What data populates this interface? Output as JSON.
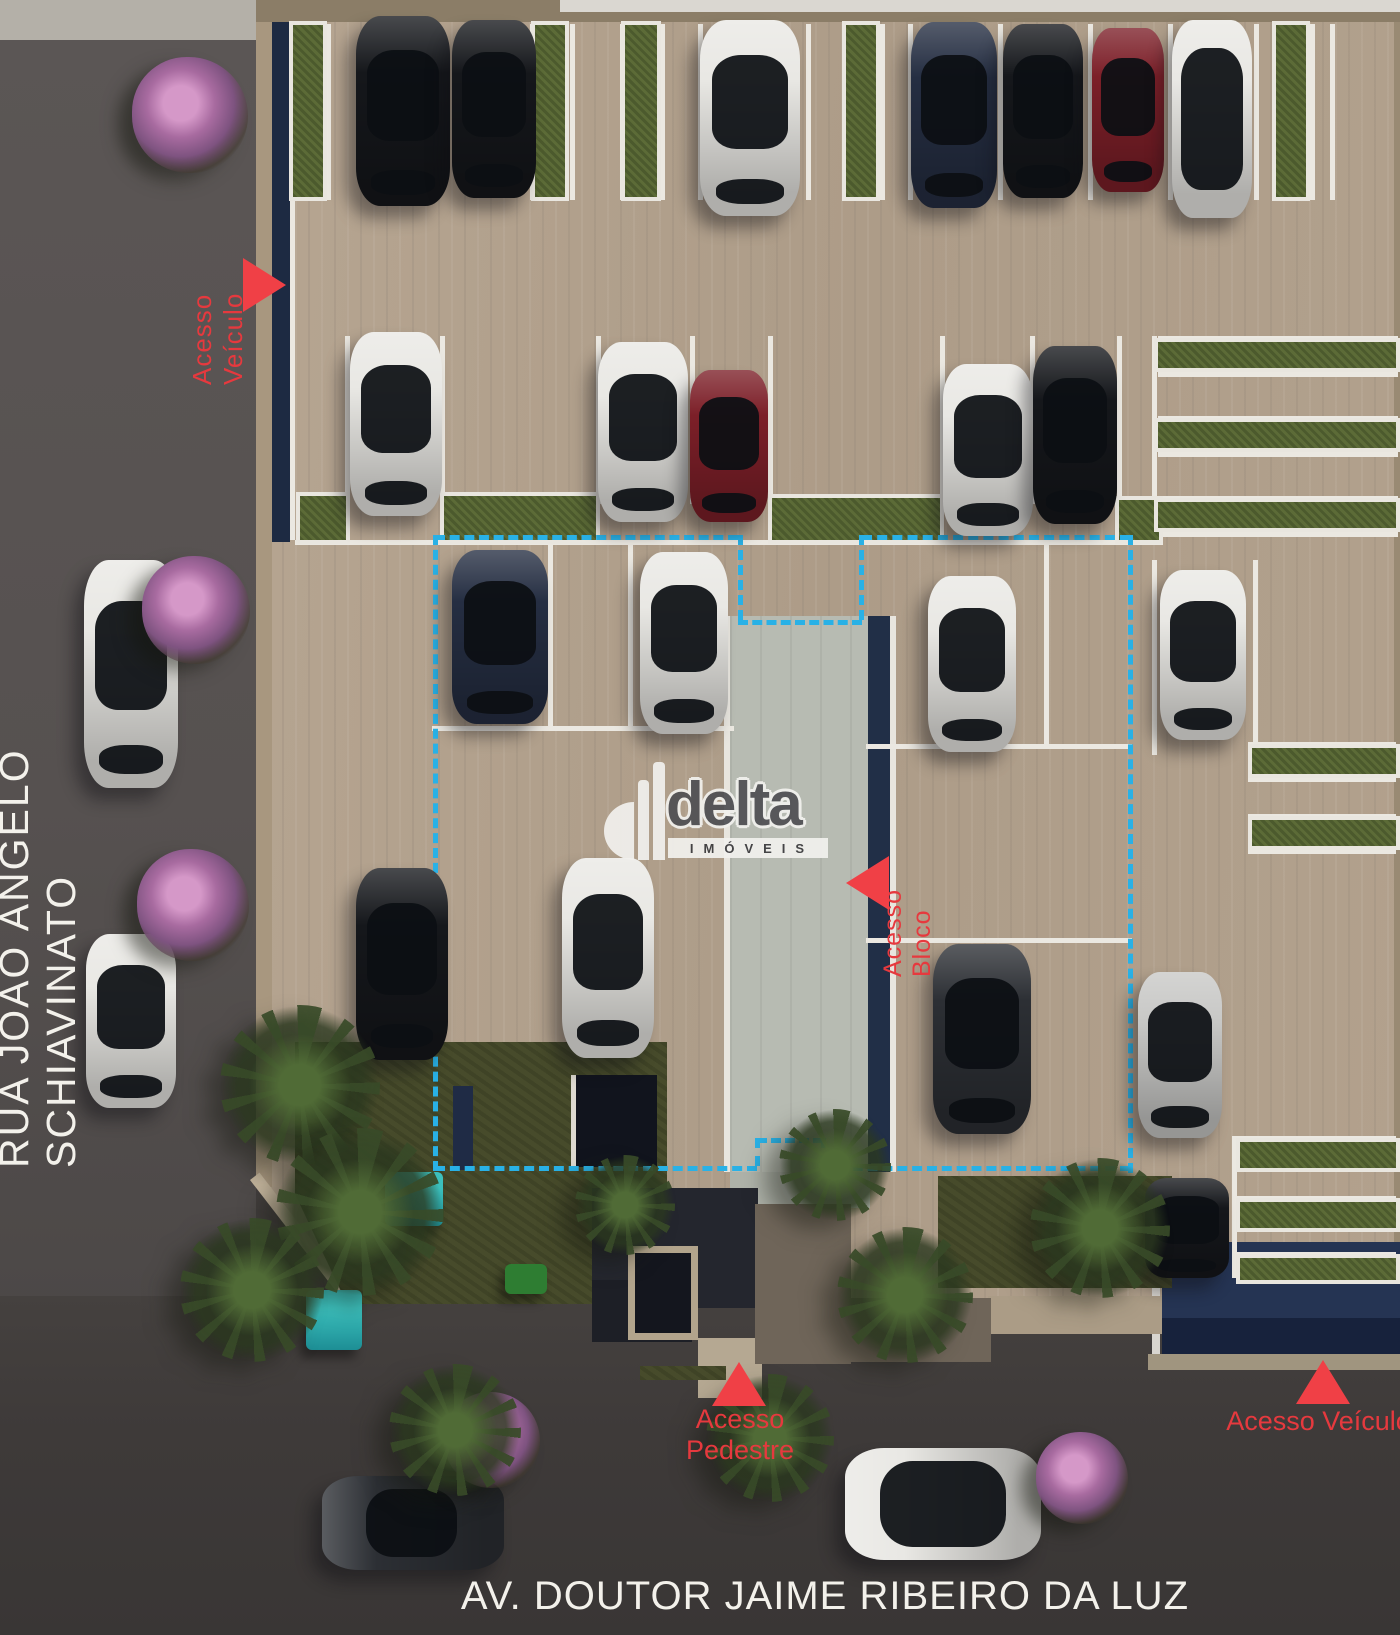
{
  "labels": {
    "street_left": "RUA JOÃO ÂNGELO SCHIAVINATO",
    "street_bottom": "AV. DOUTOR JAIME RIBEIRO DA LUZ",
    "access_vehicle_top": "Acesso Veículo",
    "access_block": "Acesso Bloco",
    "access_pedestrian": "Acesso Pedestre",
    "access_vehicle_bottom": "Acesso Veículo"
  },
  "logo": {
    "brand": "delta",
    "subtitle": "IMÓVEIS"
  },
  "colors": {
    "accent_red": "#e6393e",
    "triangle_red": "#f04046",
    "dashed_outline": "#29b1e6",
    "lot_tan": "#b3a28f",
    "walkway_gray": "#b7bbb2",
    "navy_wall": "#1d2a42",
    "teal_equipment": "#2ba8a8"
  },
  "scene": {
    "cars": [
      {
        "x": 356,
        "y": 16,
        "w": 94,
        "h": 190,
        "c": "black",
        "dir": "v"
      },
      {
        "x": 452,
        "y": 20,
        "w": 84,
        "h": 178,
        "c": "black",
        "dir": "v"
      },
      {
        "x": 700,
        "y": 20,
        "w": 100,
        "h": 196,
        "c": "white",
        "dir": "v"
      },
      {
        "x": 911,
        "y": 22,
        "w": 86,
        "h": 186,
        "c": "navy",
        "dir": "v"
      },
      {
        "x": 1003,
        "y": 24,
        "w": 80,
        "h": 174,
        "c": "black",
        "dir": "v"
      },
      {
        "x": 1092,
        "y": 28,
        "w": 72,
        "h": 164,
        "c": "red",
        "dir": "v"
      },
      {
        "x": 1172,
        "y": 20,
        "w": 80,
        "h": 198,
        "c": "white",
        "dir": "v",
        "pano": true
      },
      {
        "x": 350,
        "y": 332,
        "w": 92,
        "h": 184,
        "c": "white",
        "dir": "v"
      },
      {
        "x": 598,
        "y": 342,
        "w": 90,
        "h": 180,
        "c": "white",
        "dir": "v"
      },
      {
        "x": 690,
        "y": 370,
        "w": 78,
        "h": 152,
        "c": "red",
        "dir": "v"
      },
      {
        "x": 943,
        "y": 364,
        "w": 90,
        "h": 172,
        "c": "white",
        "dir": "v"
      },
      {
        "x": 1033,
        "y": 346,
        "w": 84,
        "h": 178,
        "c": "black",
        "dir": "v"
      },
      {
        "x": 452,
        "y": 550,
        "w": 96,
        "h": 174,
        "c": "navy",
        "dir": "v"
      },
      {
        "x": 640,
        "y": 552,
        "w": 88,
        "h": 182,
        "c": "white",
        "dir": "v"
      },
      {
        "x": 928,
        "y": 576,
        "w": 88,
        "h": 176,
        "c": "white",
        "dir": "v"
      },
      {
        "x": 1160,
        "y": 570,
        "w": 86,
        "h": 170,
        "c": "white",
        "dir": "v"
      },
      {
        "x": 356,
        "y": 868,
        "w": 92,
        "h": 192,
        "c": "black",
        "dir": "v"
      },
      {
        "x": 562,
        "y": 858,
        "w": 92,
        "h": 200,
        "c": "white",
        "dir": "v"
      },
      {
        "x": 933,
        "y": 944,
        "w": 98,
        "h": 190,
        "c": "darkgray",
        "dir": "v"
      },
      {
        "x": 1138,
        "y": 972,
        "w": 84,
        "h": 166,
        "c": "silver",
        "dir": "v"
      },
      {
        "x": 1145,
        "y": 1178,
        "w": 84,
        "h": 100,
        "c": "black",
        "dir": "v"
      },
      {
        "x": 84,
        "y": 560,
        "w": 94,
        "h": 228,
        "c": "white",
        "dir": "v"
      },
      {
        "x": 86,
        "y": 934,
        "w": 90,
        "h": 174,
        "c": "white",
        "dir": "v"
      },
      {
        "x": 322,
        "y": 1476,
        "w": 182,
        "h": 94,
        "c": "darkgray",
        "dir": "h"
      },
      {
        "x": 845,
        "y": 1448,
        "w": 196,
        "h": 112,
        "c": "white",
        "dir": "h",
        "pano": true
      }
    ],
    "trees": [
      {
        "t": "pink",
        "cx": 190,
        "cy": 115,
        "r": 58
      },
      {
        "t": "pink",
        "cx": 196,
        "cy": 610,
        "r": 54
      },
      {
        "t": "pink",
        "cx": 193,
        "cy": 905,
        "r": 56
      },
      {
        "t": "pink",
        "cx": 492,
        "cy": 1440,
        "r": 48
      },
      {
        "t": "pink",
        "cx": 1082,
        "cy": 1478,
        "r": 46
      },
      {
        "t": "palm",
        "cx": 300,
        "cy": 1085,
        "r": 80
      },
      {
        "t": "palm",
        "cx": 360,
        "cy": 1212,
        "r": 84
      },
      {
        "t": "palm",
        "cx": 252,
        "cy": 1290,
        "r": 72
      },
      {
        "t": "palm",
        "cx": 455,
        "cy": 1430,
        "r": 66
      },
      {
        "t": "palm",
        "cx": 770,
        "cy": 1438,
        "r": 64
      },
      {
        "t": "palm",
        "cx": 905,
        "cy": 1295,
        "r": 68
      },
      {
        "t": "palm",
        "cx": 835,
        "cy": 1165,
        "r": 56
      },
      {
        "t": "palm",
        "cx": 1100,
        "cy": 1228,
        "r": 70
      },
      {
        "t": "palm",
        "cx": 625,
        "cy": 1205,
        "r": 50
      }
    ],
    "hedges": [
      {
        "x": 293,
        "y": 25,
        "w": 30,
        "h": 172
      },
      {
        "x": 535,
        "y": 25,
        "w": 30,
        "h": 172
      },
      {
        "x": 625,
        "y": 25,
        "w": 32,
        "h": 172
      },
      {
        "x": 846,
        "y": 25,
        "w": 30,
        "h": 172
      },
      {
        "x": 1276,
        "y": 25,
        "w": 30,
        "h": 172
      },
      {
        "x": 300,
        "y": 496,
        "w": 46,
        "h": 44
      },
      {
        "x": 444,
        "y": 496,
        "w": 152,
        "h": 44
      },
      {
        "x": 772,
        "y": 498,
        "w": 168,
        "h": 42
      },
      {
        "x": 1119,
        "y": 500,
        "w": 40,
        "h": 40
      },
      {
        "x": 1158,
        "y": 342,
        "w": 238,
        "h": 26
      },
      {
        "x": 1158,
        "y": 422,
        "w": 238,
        "h": 26
      },
      {
        "x": 1158,
        "y": 502,
        "w": 238,
        "h": 26
      },
      {
        "x": 1252,
        "y": 748,
        "w": 144,
        "h": 26
      },
      {
        "x": 1252,
        "y": 820,
        "w": 144,
        "h": 26
      },
      {
        "x": 1240,
        "y": 1142,
        "w": 156,
        "h": 26
      },
      {
        "x": 1240,
        "y": 1202,
        "w": 156,
        "h": 26
      },
      {
        "x": 1240,
        "y": 1258,
        "w": 156,
        "h": 22
      }
    ],
    "lawns": [
      {
        "x": 295,
        "y": 1042,
        "w": 372,
        "h": 262,
        "clip": "polygon(0 0,100% 0,100% 100%,14% 100%,0 58%)"
      },
      {
        "x": 938,
        "y": 1176,
        "w": 234,
        "h": 112
      },
      {
        "x": 640,
        "y": 1366,
        "w": 86,
        "h": 14
      }
    ],
    "lines": [
      {
        "x": 290,
        "y": 24,
        "w": 5,
        "h": 516
      },
      {
        "x": 326,
        "y": 24,
        "w": 5,
        "h": 176
      },
      {
        "x": 530,
        "y": 24,
        "w": 5,
        "h": 176
      },
      {
        "x": 570,
        "y": 24,
        "w": 5,
        "h": 176
      },
      {
        "x": 620,
        "y": 24,
        "w": 5,
        "h": 176
      },
      {
        "x": 660,
        "y": 24,
        "w": 5,
        "h": 176
      },
      {
        "x": 698,
        "y": 24,
        "w": 5,
        "h": 176
      },
      {
        "x": 806,
        "y": 24,
        "w": 5,
        "h": 176
      },
      {
        "x": 843,
        "y": 24,
        "w": 5,
        "h": 176
      },
      {
        "x": 880,
        "y": 24,
        "w": 5,
        "h": 176
      },
      {
        "x": 908,
        "y": 24,
        "w": 5,
        "h": 176
      },
      {
        "x": 998,
        "y": 24,
        "w": 5,
        "h": 176
      },
      {
        "x": 1088,
        "y": 24,
        "w": 5,
        "h": 176
      },
      {
        "x": 1168,
        "y": 24,
        "w": 5,
        "h": 176
      },
      {
        "x": 1254,
        "y": 24,
        "w": 5,
        "h": 176
      },
      {
        "x": 1310,
        "y": 24,
        "w": 5,
        "h": 176
      },
      {
        "x": 1330,
        "y": 24,
        "w": 5,
        "h": 176
      },
      {
        "x": 345,
        "y": 336,
        "w": 5,
        "h": 168
      },
      {
        "x": 440,
        "y": 336,
        "w": 5,
        "h": 168
      },
      {
        "x": 596,
        "y": 336,
        "w": 5,
        "h": 168
      },
      {
        "x": 690,
        "y": 336,
        "w": 5,
        "h": 168
      },
      {
        "x": 768,
        "y": 336,
        "w": 5,
        "h": 168
      },
      {
        "x": 940,
        "y": 336,
        "w": 5,
        "h": 168
      },
      {
        "x": 1030,
        "y": 336,
        "w": 5,
        "h": 168
      },
      {
        "x": 1117,
        "y": 336,
        "w": 5,
        "h": 168
      },
      {
        "x": 295,
        "y": 540,
        "w": 868,
        "h": 5
      },
      {
        "x": 1158,
        "y": 336,
        "w": 240,
        "h": 5
      },
      {
        "x": 1158,
        "y": 372,
        "w": 240,
        "h": 5
      },
      {
        "x": 1158,
        "y": 416,
        "w": 240,
        "h": 5
      },
      {
        "x": 1158,
        "y": 452,
        "w": 240,
        "h": 5
      },
      {
        "x": 1158,
        "y": 496,
        "w": 240,
        "h": 5
      },
      {
        "x": 1158,
        "y": 532,
        "w": 240,
        "h": 5
      },
      {
        "x": 1152,
        "y": 336,
        "w": 5,
        "h": 200
      },
      {
        "x": 1152,
        "y": 560,
        "w": 5,
        "h": 195
      },
      {
        "x": 1253,
        "y": 560,
        "w": 5,
        "h": 195
      },
      {
        "x": 432,
        "y": 726,
        "w": 302,
        "h": 5
      },
      {
        "x": 548,
        "y": 540,
        "w": 5,
        "h": 186
      },
      {
        "x": 628,
        "y": 540,
        "w": 5,
        "h": 186
      },
      {
        "x": 866,
        "y": 744,
        "w": 266,
        "h": 5
      },
      {
        "x": 866,
        "y": 938,
        "w": 266,
        "h": 5
      },
      {
        "x": 1044,
        "y": 540,
        "w": 5,
        "h": 204
      },
      {
        "x": 1248,
        "y": 742,
        "w": 148,
        "h": 4
      },
      {
        "x": 1248,
        "y": 778,
        "w": 148,
        "h": 4
      },
      {
        "x": 1248,
        "y": 814,
        "w": 148,
        "h": 4
      },
      {
        "x": 1248,
        "y": 850,
        "w": 148,
        "h": 4
      },
      {
        "x": 1236,
        "y": 1136,
        "w": 160,
        "h": 5
      },
      {
        "x": 1236,
        "y": 1196,
        "w": 160,
        "h": 5
      },
      {
        "x": 1236,
        "y": 1252,
        "w": 160,
        "h": 5
      },
      {
        "x": 1232,
        "y": 1136,
        "w": 5,
        "h": 142
      }
    ],
    "equipment": [
      {
        "x": 385,
        "y": 1172,
        "w": 58,
        "h": 54
      },
      {
        "x": 306,
        "y": 1290,
        "w": 56,
        "h": 60
      },
      {
        "x": 505,
        "y": 1264,
        "w": 42,
        "h": 30,
        "c": "#2e7d32"
      }
    ]
  }
}
